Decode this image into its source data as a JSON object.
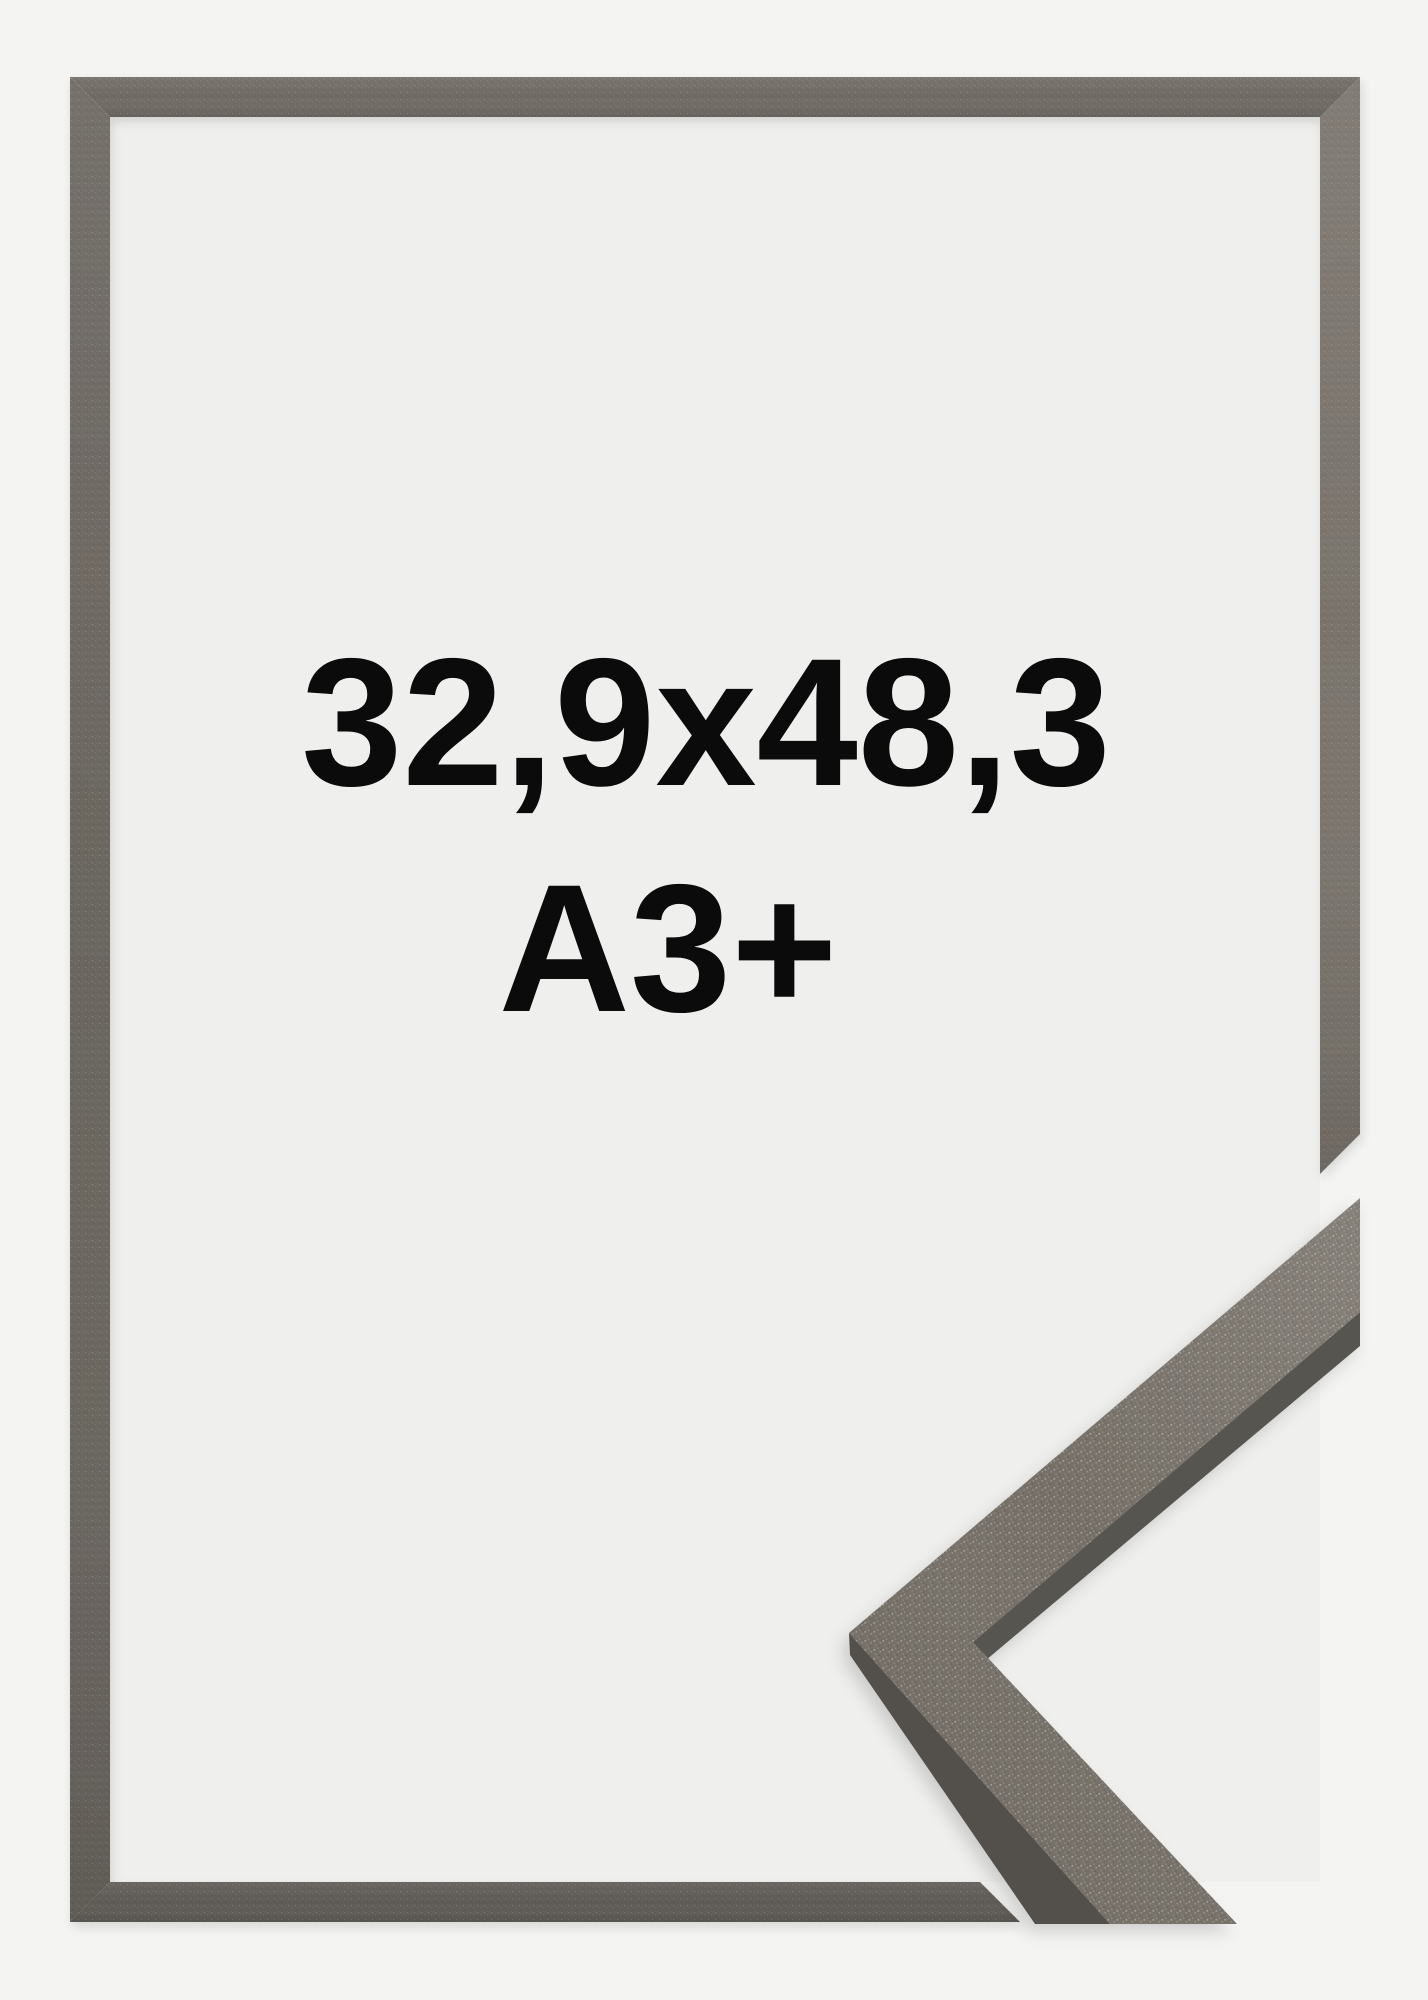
{
  "labels": {
    "size": "32,9x48,3",
    "format": "A3+"
  },
  "colors": {
    "background": "#f4f4f2",
    "frame_interior": "#efefed",
    "text": "#0b0b0b",
    "frame_top_bar": "#6f6a64",
    "frame_left_bar": "#6a655f",
    "frame_right_bar": "#79736c",
    "frame_bottom_bar": "#5e5a55",
    "corner_sample_face": "#767068",
    "corner_sample_outer_side": "#524f4b",
    "corner_sample_inner_side": "#575450"
  }
}
